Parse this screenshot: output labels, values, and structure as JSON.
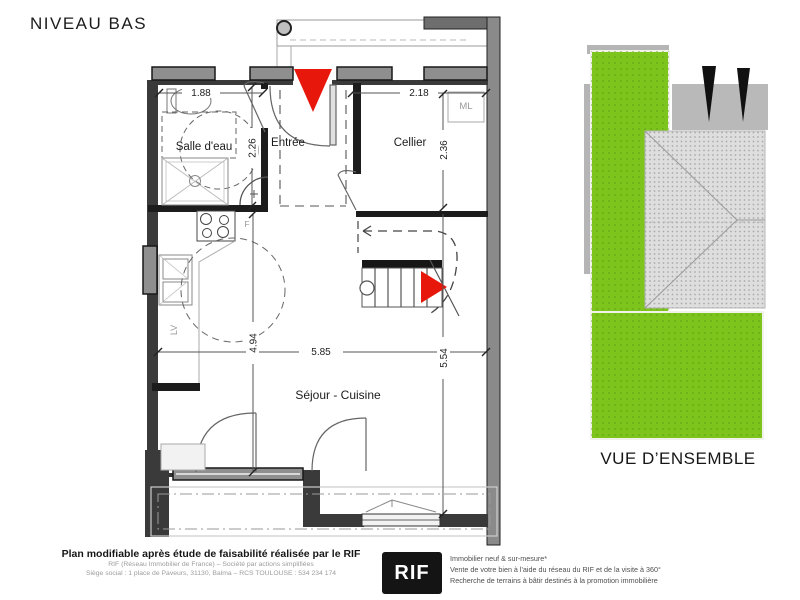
{
  "title": "NIVEAU BAS",
  "plan": {
    "rooms": {
      "bathroom": "Salle d'eau",
      "entry": "Entrée",
      "cellar": "Cellier",
      "living": "Séjour - Cuisine"
    },
    "appliances": {
      "washing_machine": "ML",
      "fridge": "F",
      "dishwasher": "LV"
    },
    "dimensions": {
      "bathroom_width": "1.88",
      "cellar_width": "2.18",
      "bathroom_depth": "2.26",
      "cellar_depth": "2.36",
      "living_depth_left": "4.94",
      "living_width": "5.85",
      "living_depth_right": "5.54"
    }
  },
  "overview": {
    "label": "VUE D’ENSEMBLE"
  },
  "footer": {
    "disclaimer_bold": "Plan modifiable après étude de faisabilité réalisée par le RIF",
    "company_line1": "RIF (Réseau Immobilier de France) – Société par actions simplifiées",
    "company_line2": "Siège social : 1 place de Paveurs, 31130, Balma – RCS TOULOUSE : 534 234 174",
    "logo_text": "RIF",
    "services": [
      "Immobilier neuf & sur-mesure*",
      "Vente de votre bien à l'aide du réseau du RIF et de la visite à 360°",
      "Recherche de terrains à bâtir destinés à la promotion immobilière"
    ]
  },
  "colors": {
    "accent_red": "#e8170c",
    "lawn_green": "#7dc41c",
    "driveway_gray": "#b9b9b9",
    "roof_gray": "#dedede"
  }
}
